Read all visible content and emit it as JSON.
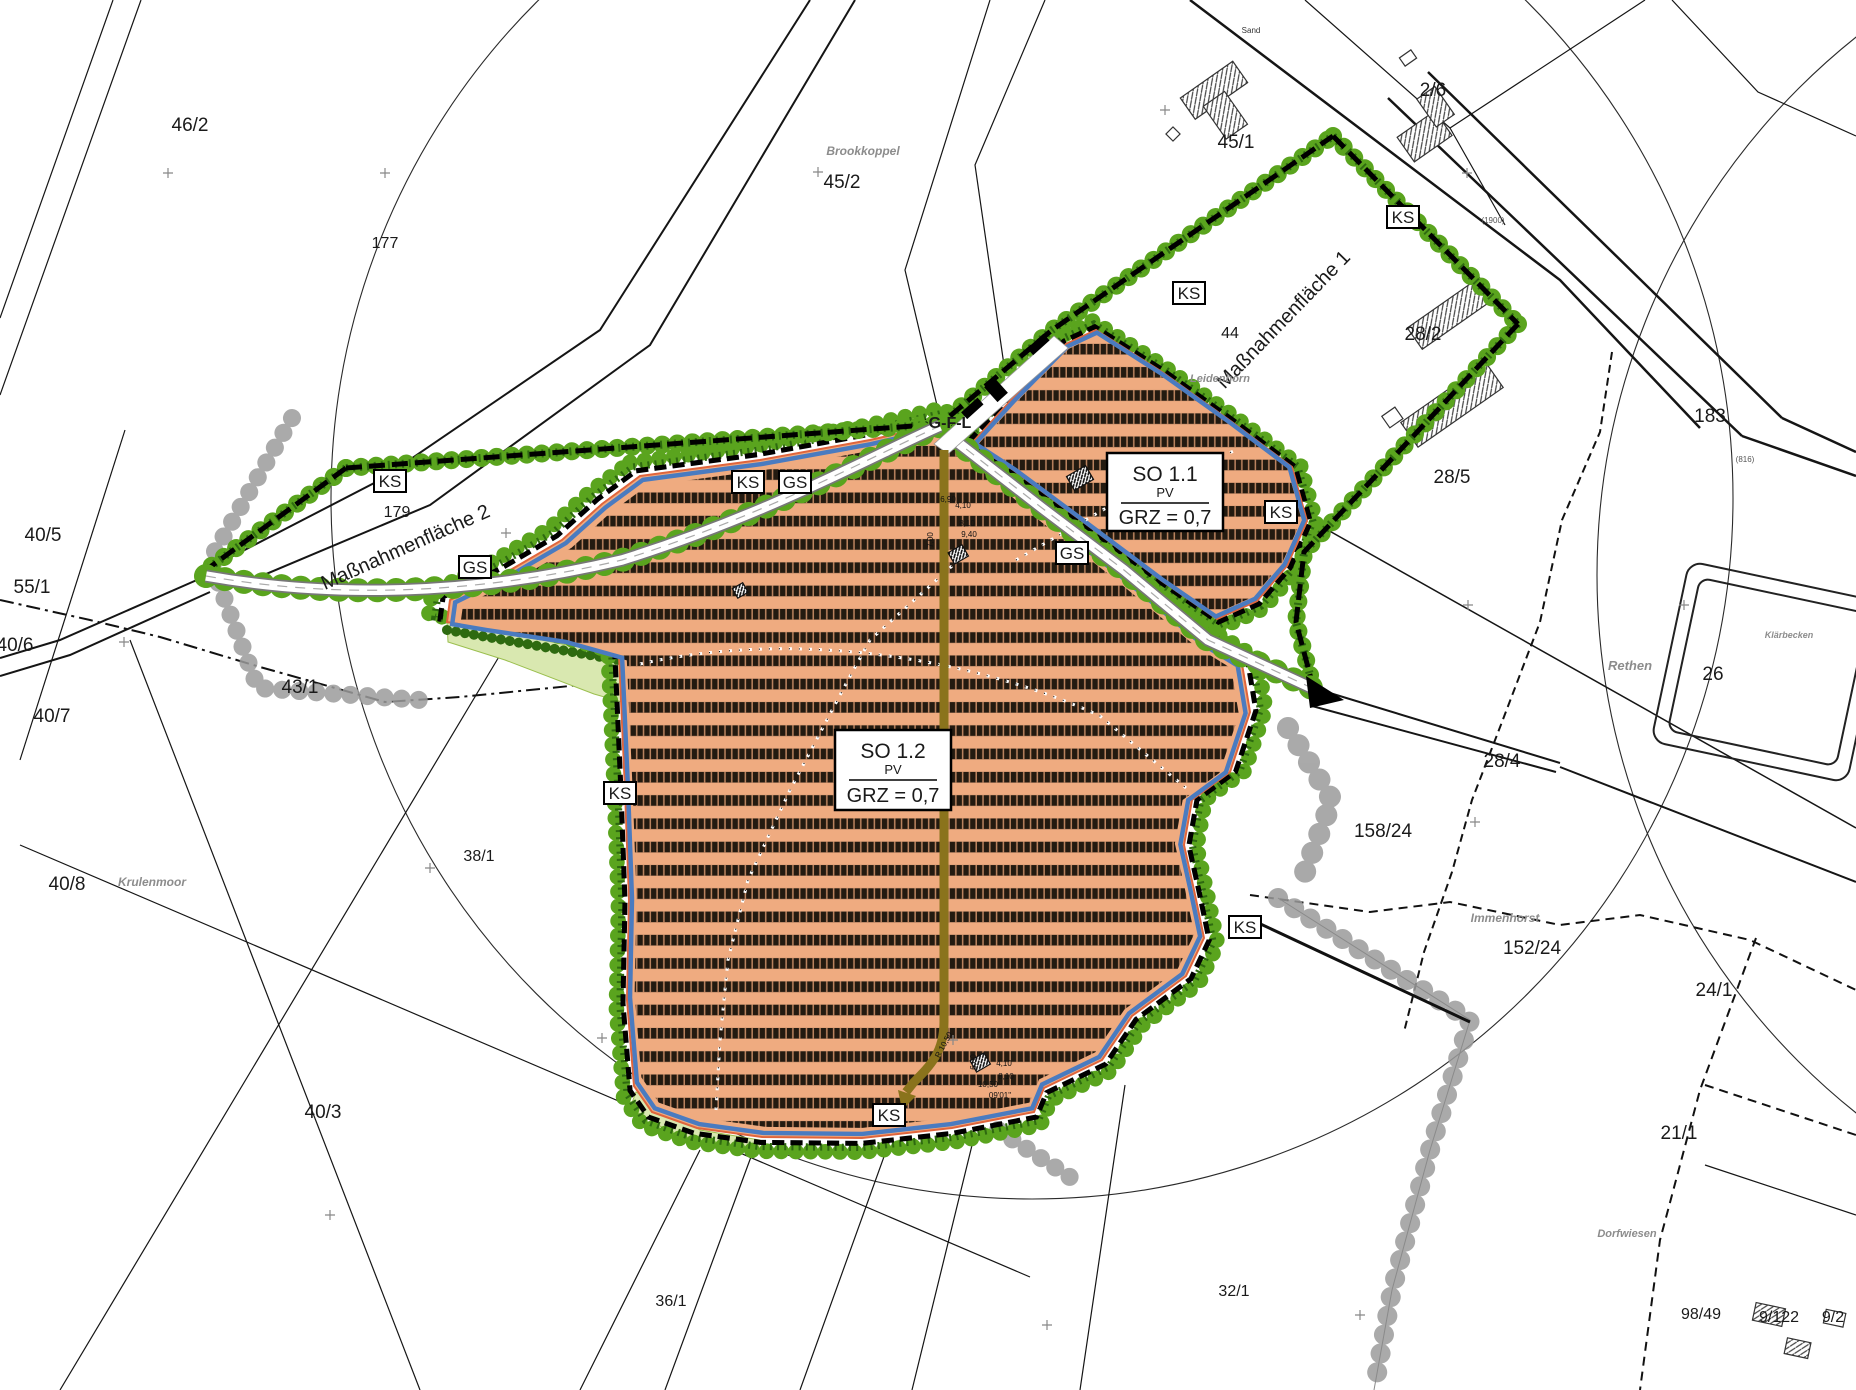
{
  "map": {
    "ks": "KS",
    "gs": "GS",
    "so_boxes": [
      {
        "name": "SO 1.1",
        "use": "PV",
        "grz": "GRZ = 0,7"
      },
      {
        "name": "SO 1.2",
        "use": "PV",
        "grz": "GRZ = 0,7"
      }
    ],
    "labels": [
      {
        "text": "46/2"
      },
      {
        "text": "177"
      },
      {
        "text": "Brookkoppel"
      },
      {
        "text": "45/2"
      },
      {
        "text": "45/1"
      },
      {
        "text": "2/6"
      },
      {
        "text": "44"
      },
      {
        "text": "Maßnahmenfläche 1"
      },
      {
        "text": "Maßnahmenfläche 2"
      },
      {
        "text": "28/2"
      },
      {
        "text": "183"
      },
      {
        "text": "28/5"
      },
      {
        "text": "Leidenhorn"
      },
      {
        "text": "G-F-L"
      },
      {
        "text": "179"
      },
      {
        "text": "40/5"
      },
      {
        "text": "55/1"
      },
      {
        "text": "40/6"
      },
      {
        "text": "40/7"
      },
      {
        "text": "43/1"
      },
      {
        "text": "40/8"
      },
      {
        "text": "Krulenmoor"
      },
      {
        "text": "38/1"
      },
      {
        "text": "40/3"
      },
      {
        "text": "36/1"
      },
      {
        "text": "32/1"
      },
      {
        "text": "158/24"
      },
      {
        "text": "28/4"
      },
      {
        "text": "Rethen"
      },
      {
        "text": "26"
      },
      {
        "text": "Klärbecken"
      },
      {
        "text": "Immenhorst"
      },
      {
        "text": "152/24"
      },
      {
        "text": "24/1"
      },
      {
        "text": "21/1"
      },
      {
        "text": "Dorfwiesen"
      },
      {
        "text": "98/49"
      },
      {
        "text": "9/122"
      },
      {
        "text": "9/2"
      },
      {
        "text": "(1900)"
      },
      {
        "text": "(816)"
      },
      {
        "text": "Sand"
      },
      {
        "text": "4,10"
      },
      {
        "text": "8,10"
      },
      {
        "text": "9,40"
      },
      {
        "text": "7,00"
      },
      {
        "text": "6,90"
      },
      {
        "text": "R 10,50"
      },
      {
        "text": "10,50"
      },
      {
        "text": "4,10"
      },
      {
        "text": "8,10"
      },
      {
        "text": "6,00"
      },
      {
        "text": "09'01\""
      }
    ],
    "colors": {
      "pv_field": "#efab80",
      "inner_boundary_blue": "#4a7bc0",
      "edge_red": "#e0653c",
      "planting_green": "#5aa41e",
      "shrub_green": "#2e6a10",
      "pale_green": "#d9e8b0",
      "track_brown": "#8a731c"
    }
  }
}
